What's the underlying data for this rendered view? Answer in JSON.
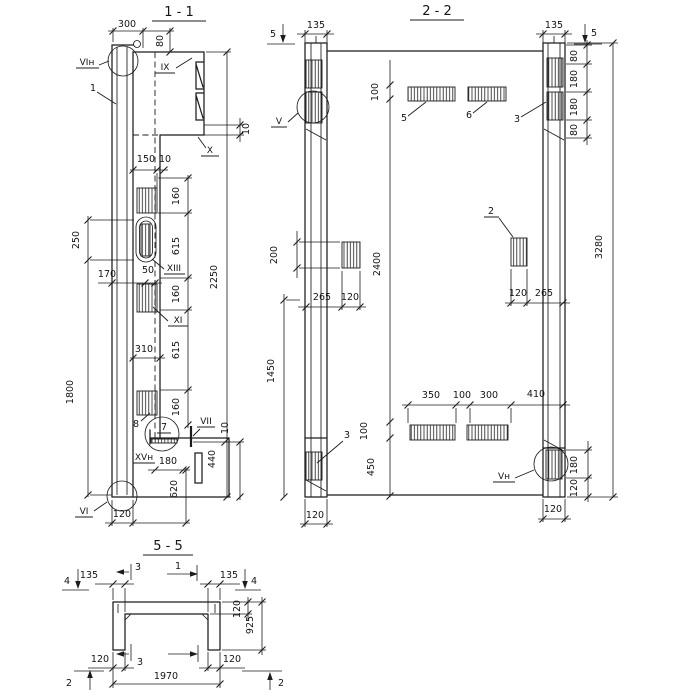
{
  "app": {
    "background": "#ffffff",
    "ink": "#1c1c1c"
  },
  "sections": {
    "s11": {
      "title": "1 - 1",
      "dims": {
        "top_width": "300",
        "top_height": "80",
        "step_gap": "10",
        "inner_150": "150",
        "inner_10": "10",
        "left_250": "250",
        "left_1800": "1800",
        "inner_170": "170",
        "inner_50": "50",
        "inner_310": "310",
        "chain_160a": "160",
        "chain_615a": "615",
        "chain_160b": "160",
        "chain_615b": "615",
        "chain_160c": "160",
        "overall_2250": "2250",
        "foot_10": "10",
        "foot_440": "440",
        "foot_620": "620",
        "foot_180": "180",
        "bottom_120": "120"
      },
      "labels": {
        "vi_top": "VIн",
        "item_1": "1",
        "ix": "IX",
        "x": "X",
        "xiii": "XIII",
        "xi": "XI",
        "vii": "VII",
        "xv": "XVн",
        "vi_bottom": "VI",
        "item_7": "7",
        "item_8": "8"
      }
    },
    "s22": {
      "title": "2 - 2",
      "dims": {
        "flange_135_left": "135",
        "flange_135_right": "135",
        "right_80a": "80",
        "right_180a": "180",
        "right_180b": "180",
        "right_80b": "80",
        "overall_3280": "3280",
        "mid_100_top": "100",
        "mid_2400": "2400",
        "mid_100_bottom": "100",
        "mid_450": "450",
        "left_200": "200",
        "left_1450": "1450",
        "midleft_265": "265",
        "midleft_120": "120",
        "midright_120": "120",
        "midright_265": "265",
        "bottom_350": "350",
        "bottom_100": "100",
        "bottom_300": "300",
        "bottom_410": "410",
        "corner_180": "180",
        "corner_120": "120",
        "col_120_left": "120",
        "col_120_right": "120"
      },
      "labels": {
        "v": "V",
        "v_bottom": "Vн",
        "item_2": "2",
        "item_3_top": "3",
        "item_3_bottom": "3",
        "item_5": "5",
        "item_6": "6"
      },
      "marks": {
        "cut5_left": "5",
        "cut5_right": "5"
      }
    },
    "s55": {
      "title": "5 - 5",
      "dims": {
        "flange_135_left": "135",
        "flange_135_right": "135",
        "web_120": "120",
        "depth_925": "925",
        "bottom_120_left": "120",
        "bottom_120_right": "120",
        "overall_1970": "1970"
      },
      "marks": {
        "cut4_left": "4",
        "cut4_right": "4",
        "cut3_top": "3",
        "cut1_top": "1",
        "cut3_bottom": "3",
        "cut2_left": "2",
        "cut2_right": "2"
      }
    }
  }
}
